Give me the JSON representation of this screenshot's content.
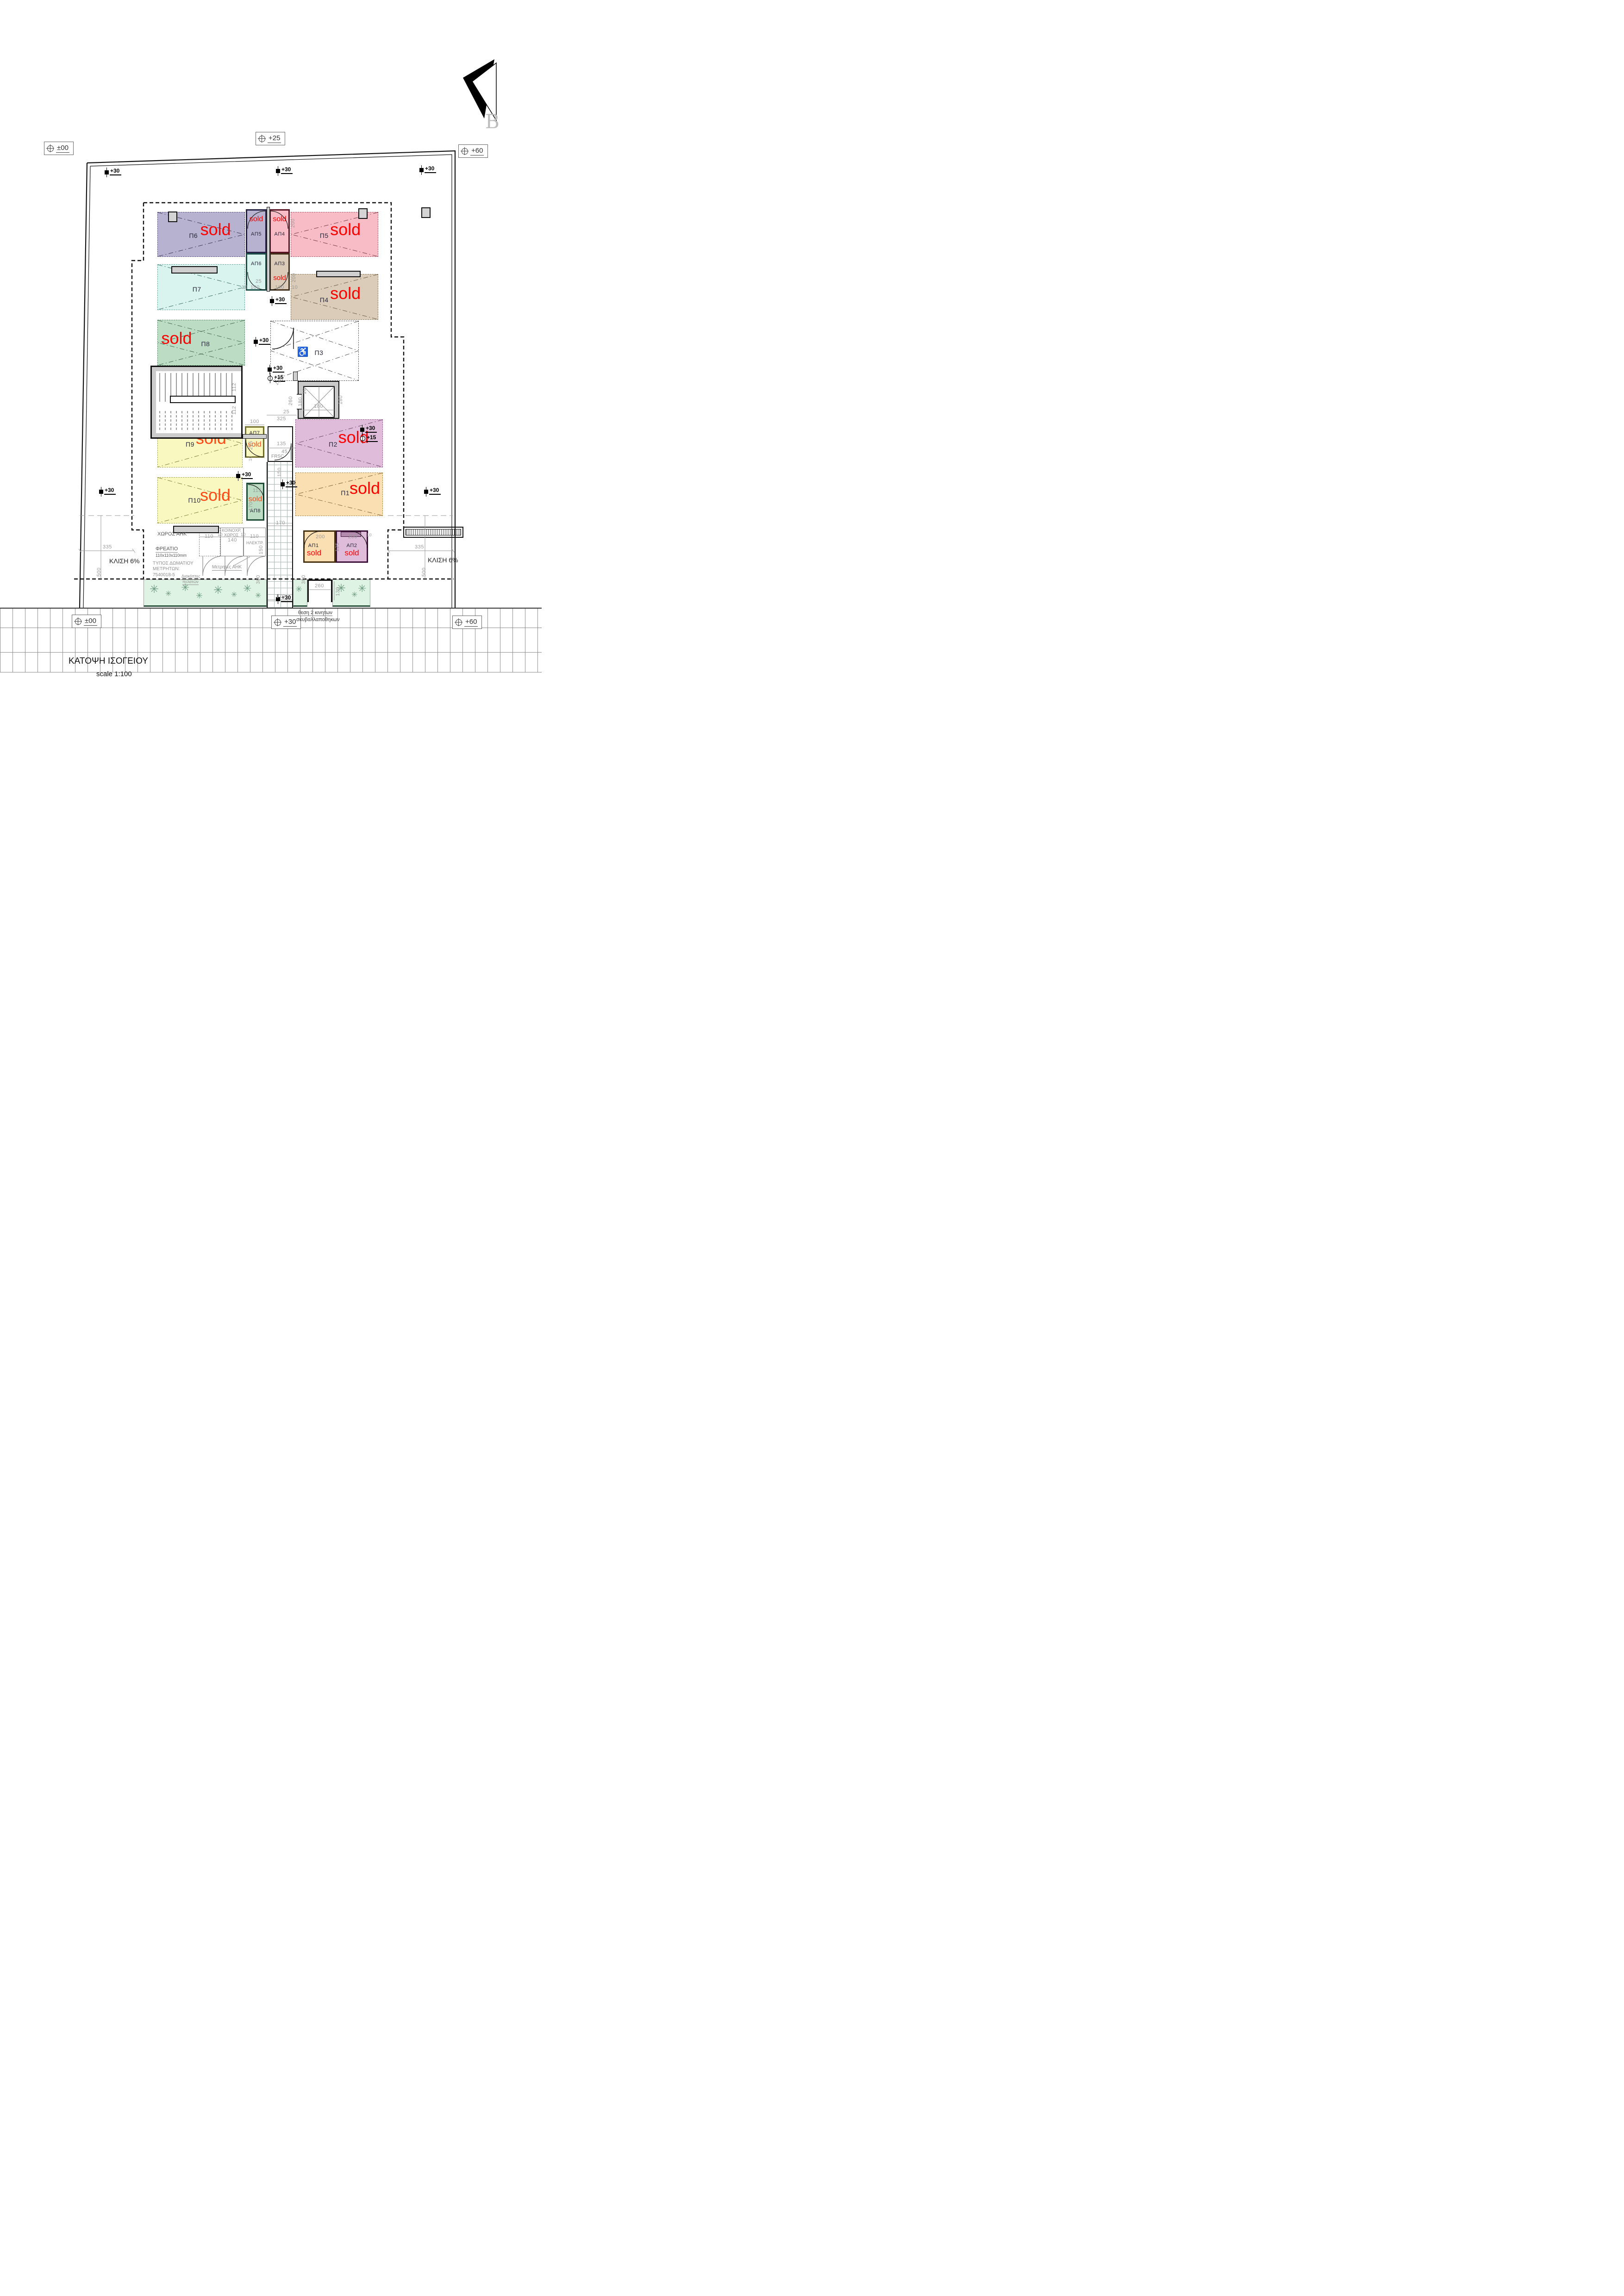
{
  "meta": {
    "title": "ΚΑΤΟΨΗ ΙΣΟΓΕΙΟΥ",
    "scale_label": "scale 1:100",
    "north_letter": "B",
    "sold_label": "sold"
  },
  "colors": {
    "sold_red": "#ff0000",
    "sold_orange": "#ff4a17",
    "landscape_green": "#def3e3",
    "plant_green": "#6d9b80",
    "wall_gray": "#cfcfcf",
    "dim_gray": "#9a9a9a"
  },
  "level_markers": {
    "top_left": "±00",
    "top_center": "+25",
    "top_right": "+60",
    "bottom_left": "±00",
    "bottom_center": "+30",
    "bottom_right": "+60",
    "spot_30": "+30",
    "spot_15": "+15"
  },
  "parking_spaces": [
    {
      "id": "Π6",
      "sold": true,
      "fill": "#b7b2d0",
      "line": "#57517e"
    },
    {
      "id": "Π7",
      "sold": false,
      "fill": "#d9f3ee",
      "line": "#68a39b"
    },
    {
      "id": "Π8",
      "sold": true,
      "fill": "#bcdcc4",
      "line": "#5d8a6b"
    },
    {
      "id": "Π5",
      "sold": true,
      "fill": "#f8bcc6",
      "line": "#a05767"
    },
    {
      "id": "Π4",
      "sold": true,
      "fill": "#daccb8",
      "line": "#8a7a5f"
    },
    {
      "id": "Π3",
      "sold": false,
      "fill": "#ffffff",
      "line": "#666666",
      "accessible": true
    },
    {
      "id": "Π9",
      "sold": true,
      "fill": "#f9f8c0",
      "line": "#a3a04e"
    },
    {
      "id": "Π10",
      "sold": true,
      "fill": "#f9f8c0",
      "line": "#a3a04e"
    },
    {
      "id": "Π2",
      "sold": true,
      "fill": "#dfbcda",
      "line": "#96628f"
    },
    {
      "id": "Π1",
      "sold": true,
      "fill": "#fadfb2",
      "line": "#a8854c"
    }
  ],
  "storage_rooms": [
    {
      "id": "ΑΠ5",
      "sold": true,
      "fill": "#b7b2d0",
      "line": "#262347"
    },
    {
      "id": "ΑΠ4",
      "sold": true,
      "fill": "#f8bcc6",
      "line": "#5a1524"
    },
    {
      "id": "ΑΠ6",
      "sold": false,
      "fill": "#d9f3ee",
      "line": "#1b5049"
    },
    {
      "id": "ΑΠ3",
      "sold": true,
      "fill": "#daccb8",
      "line": "#43301a"
    },
    {
      "id": "ΑΠ7",
      "sold": true,
      "fill": "#f9f8c0",
      "line": "#706e2a"
    },
    {
      "id": "ΑΠ8",
      "sold": true,
      "fill": "#bcdcc4",
      "line": "#1d4a34"
    },
    {
      "id": "ΑΠ1",
      "sold": true,
      "fill": "#fadfb2",
      "line": "#45310f"
    },
    {
      "id": "ΑΠ2",
      "sold": true,
      "fill": "#dfbcda",
      "line": "#3d1239"
    }
  ],
  "annotations": {
    "xoros_ahk": "ΧΩΡΟΣ ΑΗΚ",
    "freatio": "ΦΡΕΑΤΙΟ",
    "freatio_size": "110x110x110mm",
    "typos1": "ΤΥΠΟΣ ΔΩΜΑΤΙΟΥ",
    "typos2": "ΜΕΤΡΗΤΩΝ:",
    "typos3": "7540018-5",
    "diakoptes1": "Διακόπτες",
    "diakoptes2": "πελατών",
    "metrites": "Μετρητές ΑΗΚ",
    "koinoxr1": "ΚΟΙΝΟΧΡ.",
    "koinoxr2": "ΧΩΡΟΣ",
    "ilektr": "ΗΛΕΚΤΡ.",
    "frsc": "FRSC",
    "bins1": "θεση 2 κινητων",
    "bins2": "σκυβαλλαποθηκων",
    "klisi": "ΚΛΙΣΗ 6%",
    "wheelchair_icon": "♿"
  },
  "dims": {
    "v10": "10",
    "v25": "25",
    "v45": "45",
    "v100": "100",
    "v110": "110",
    "v112": "112",
    "v115": "115",
    "v125": "125",
    "v130": "130",
    "v135": "135",
    "v140": "140",
    "v150": "150",
    "v170": "170",
    "v180": "180",
    "v200": "200",
    "v215": "215",
    "v260": "260",
    "v300": "300",
    "v325": "325",
    "v335": "335",
    "v500": "500"
  }
}
